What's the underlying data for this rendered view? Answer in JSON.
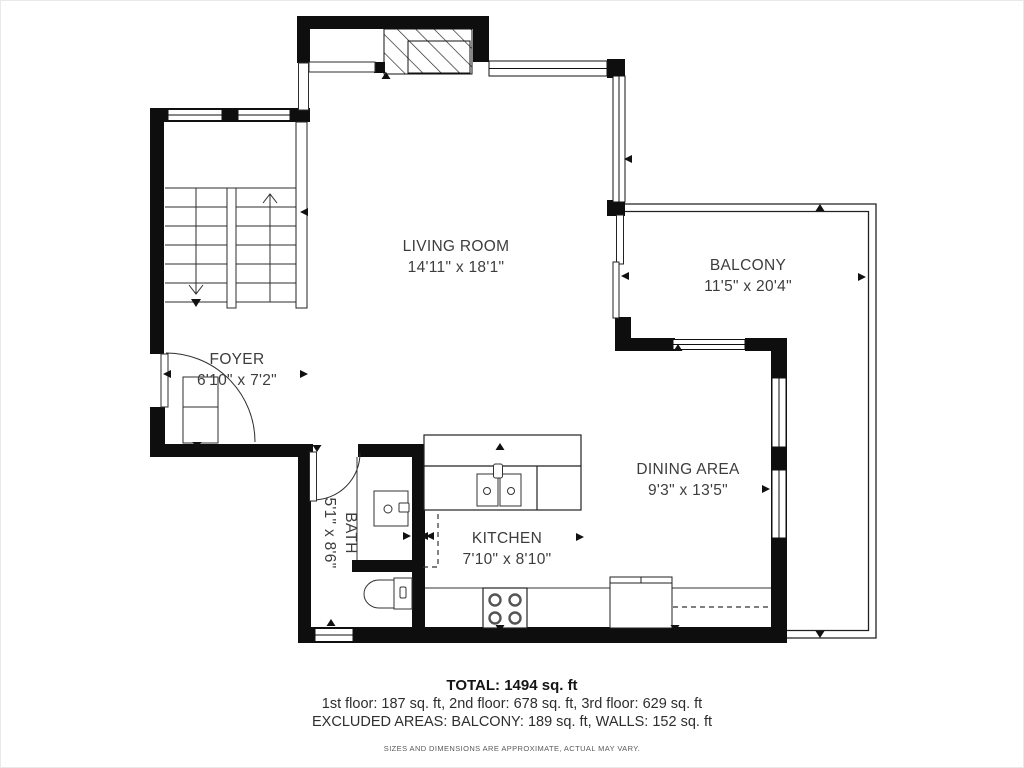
{
  "plan": {
    "rooms": [
      {
        "name": "LIVING ROOM",
        "dims": "14'11\" x 18'1\""
      },
      {
        "name": "BALCONY",
        "dims": "11'5\" x 20'4\""
      },
      {
        "name": "FOYER",
        "dims": "6'10\" x 7'2\""
      },
      {
        "name": "DINING AREA",
        "dims": "9'3\" x 13'5\""
      },
      {
        "name": "KITCHEN",
        "dims": "7'10\" x 8'10\""
      },
      {
        "name": "BATH",
        "dims": "5'1\" x 8'6\""
      }
    ],
    "summary": {
      "total": "TOTAL: 1494 sq. ft",
      "floors": "1st floor: 187 sq. ft, 2nd floor: 678 sq. ft, 3rd floor: 629 sq. ft",
      "excluded": "EXCLUDED AREAS: BALCONY: 189 sq. ft, WALLS: 152 sq. ft",
      "disclaimer": "SIZES AND DIMENSIONS ARE APPROXIMATE, ACTUAL MAY VARY."
    },
    "colors": {
      "wall": "#0e0e0e",
      "line": "#2e2e2e",
      "text": "#3d3d3d"
    }
  }
}
